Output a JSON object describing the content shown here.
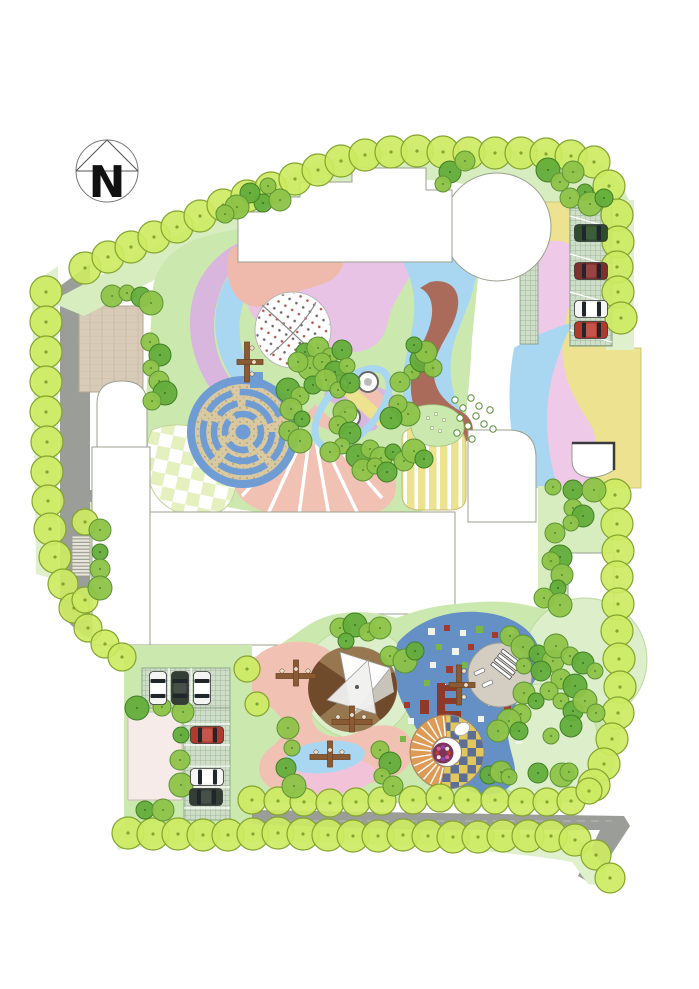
{
  "meta": {
    "width": 699,
    "height": 989,
    "plan_type": "landscape-site-plan"
  },
  "compass": {
    "label": "N"
  },
  "palette": {
    "bg": "#ffffff",
    "road": "#9b9d99",
    "paleStrip": "#dff0cd",
    "lawnBand": "#d7edc0",
    "lawn": "#cbe8ae",
    "paleCircle": "#ddeecb",
    "treePerimeterFill": "#cdea62",
    "treePerimeterEdge": "#84a430",
    "treeMedFill": "#8dc348",
    "treeMedEdge": "#5c9334",
    "treeDarkFill": "#63ad3b",
    "treeDarkEdge": "#417f24",
    "purpleBand": "#d9b6de",
    "blueLight": "#a9d7f1",
    "blueDeep": "#6490c6",
    "mazeBlue": "#6e9cd3",
    "mazeSand": "#d9c9a2",
    "salmon": "#efb9ab",
    "fanSalmon": "#f1c2b4",
    "purpleBig": "#e9c3e6",
    "rightPink": "#eec9e8",
    "yellow": "#ece28f",
    "brown": "#ab6b5a",
    "tanPlaza": "#d8cbb8",
    "gridBg": "#cedec8",
    "gridLine": "#93ab8d",
    "checkPale": "#e4f0bd",
    "checkYellow": "#e3c75a",
    "checkNavy": "#5d6e96",
    "amphOrange": "#de9b55",
    "plazaGray": "#d4cdc2",
    "sandRing": "#c7b193",
    "wedgeDark": "#6f4a2b",
    "wedgeMid": "#97774f",
    "wood": "#8a5a33",
    "woodDark": "#6e4526",
    "carWhite": "#f4f4f2",
    "carRed": "#b03a2e",
    "carDarkRed": "#7c3030",
    "carGreen": "#2f4c30",
    "carDark": "#343d36",
    "pixWhite": "#f2f2ee",
    "pixRed": "#a03c2e",
    "pixGreen": "#79b547",
    "pixYellow": "#e3cf58",
    "structRed": "#8e3a2a",
    "flowerBed": "#7c3558",
    "blobPink": "#f2c3d8",
    "pinkPlaza": "#f6ebe9",
    "buildingStroke": "#9aa08f"
  },
  "trees": {
    "perimeter": [
      [
        85,
        268
      ],
      [
        108,
        257
      ],
      [
        131,
        247
      ],
      [
        154,
        237
      ],
      [
        177,
        227
      ],
      [
        200,
        216
      ],
      [
        223,
        205
      ],
      [
        247,
        196
      ],
      [
        271,
        188
      ],
      [
        295,
        179
      ],
      [
        318,
        170
      ],
      [
        341,
        161
      ],
      [
        365,
        155
      ],
      [
        391,
        152
      ],
      [
        417,
        151
      ],
      [
        443,
        152
      ],
      [
        469,
        153
      ],
      [
        495,
        153
      ],
      [
        521,
        153
      ],
      [
        546,
        154
      ],
      [
        571,
        156
      ],
      [
        594,
        162
      ],
      [
        609,
        186
      ],
      [
        617,
        215
      ],
      [
        618,
        242
      ],
      [
        617,
        267
      ],
      [
        618,
        292
      ],
      [
        621,
        318
      ],
      [
        615,
        495
      ],
      [
        617,
        524
      ],
      [
        618,
        551
      ],
      [
        617,
        577
      ],
      [
        618,
        604
      ],
      [
        617,
        631
      ],
      [
        619,
        659
      ],
      [
        620,
        687
      ],
      [
        618,
        713
      ],
      [
        612,
        739
      ],
      [
        604,
        764
      ],
      [
        594,
        785
      ],
      [
        46,
        292
      ],
      [
        46,
        322
      ],
      [
        46,
        352
      ],
      [
        46,
        382
      ],
      [
        46,
        412
      ],
      [
        47,
        442
      ],
      [
        47,
        472
      ],
      [
        48,
        501
      ],
      [
        50,
        529
      ],
      [
        55,
        557
      ],
      [
        63,
        584,
        15
      ],
      [
        74,
        608,
        15
      ],
      [
        88,
        628,
        14
      ],
      [
        105,
        644,
        14
      ],
      [
        122,
        657,
        14
      ],
      [
        85,
        522,
        13
      ],
      [
        85,
        600,
        13
      ],
      [
        247,
        669,
        13
      ],
      [
        257,
        704,
        12
      ],
      [
        128,
        833
      ],
      [
        153,
        834
      ],
      [
        178,
        834
      ],
      [
        203,
        835
      ],
      [
        228,
        835
      ],
      [
        253,
        834
      ],
      [
        278,
        833
      ],
      [
        303,
        834
      ],
      [
        328,
        835
      ],
      [
        353,
        836
      ],
      [
        378,
        836
      ],
      [
        403,
        835
      ],
      [
        428,
        836
      ],
      [
        453,
        837
      ],
      [
        478,
        837
      ],
      [
        503,
        836
      ],
      [
        528,
        836
      ],
      [
        551,
        836
      ],
      [
        575,
        840
      ],
      [
        596,
        855,
        15
      ],
      [
        610,
        878,
        15
      ],
      [
        252,
        800,
        14
      ],
      [
        278,
        801,
        14
      ],
      [
        304,
        802,
        14
      ],
      [
        330,
        803,
        14
      ],
      [
        356,
        802,
        14
      ],
      [
        382,
        801,
        14
      ],
      [
        413,
        800,
        14
      ],
      [
        440,
        798,
        14
      ],
      [
        468,
        800,
        14
      ],
      [
        495,
        800,
        14
      ],
      [
        522,
        802,
        14
      ],
      [
        547,
        802,
        14
      ],
      [
        571,
        801,
        14
      ],
      [
        589,
        791,
        13
      ]
    ],
    "medium": [
      [
        263,
        203
      ],
      [
        280,
        200
      ],
      [
        268,
        186
      ],
      [
        250,
        193
      ],
      [
        237,
        207
      ],
      [
        225,
        214
      ],
      [
        450,
        172
      ],
      [
        443,
        184
      ],
      [
        465,
        161
      ],
      [
        548,
        170
      ],
      [
        560,
        182
      ],
      [
        573,
        172
      ],
      [
        585,
        192
      ],
      [
        570,
        198
      ],
      [
        590,
        204
      ],
      [
        604,
        198
      ],
      [
        112,
        296
      ],
      [
        127,
        293
      ],
      [
        141,
        297
      ],
      [
        151,
        303
      ],
      [
        150,
        342
      ],
      [
        160,
        355
      ],
      [
        151,
        368
      ],
      [
        159,
        381
      ],
      [
        165,
        393
      ],
      [
        152,
        401
      ],
      [
        100,
        530
      ],
      [
        100,
        552
      ],
      [
        100,
        569
      ],
      [
        100,
        588
      ],
      [
        305,
        352
      ],
      [
        318,
        348
      ],
      [
        330,
        356
      ],
      [
        342,
        350
      ],
      [
        310,
        368
      ],
      [
        322,
        362
      ],
      [
        335,
        372
      ],
      [
        347,
        366
      ],
      [
        298,
        362
      ],
      [
        288,
        390
      ],
      [
        300,
        396
      ],
      [
        291,
        409
      ],
      [
        302,
        419
      ],
      [
        289,
        431
      ],
      [
        300,
        441
      ],
      [
        313,
        385
      ],
      [
        326,
        380
      ],
      [
        338,
        390
      ],
      [
        350,
        383
      ],
      [
        345,
        412
      ],
      [
        338,
        425
      ],
      [
        350,
        433
      ],
      [
        342,
        446
      ],
      [
        330,
        452
      ],
      [
        358,
        456
      ],
      [
        370,
        449
      ],
      [
        381,
        458
      ],
      [
        393,
        452
      ],
      [
        404,
        461
      ],
      [
        414,
        451
      ],
      [
        424,
        459
      ],
      [
        363,
        470
      ],
      [
        375,
        466
      ],
      [
        387,
        472
      ],
      [
        408,
        414
      ],
      [
        398,
        404
      ],
      [
        391,
        418
      ],
      [
        412,
        372
      ],
      [
        400,
        382
      ],
      [
        422,
        360
      ],
      [
        433,
        368
      ],
      [
        426,
        352
      ],
      [
        414,
        345
      ],
      [
        510,
        636
      ],
      [
        523,
        647
      ],
      [
        538,
        654
      ],
      [
        553,
        661
      ],
      [
        524,
        666
      ],
      [
        541,
        671
      ],
      [
        556,
        646
      ],
      [
        570,
        656
      ],
      [
        583,
        663
      ],
      [
        595,
        671
      ],
      [
        561,
        679
      ],
      [
        575,
        686
      ],
      [
        549,
        691
      ],
      [
        524,
        693
      ],
      [
        536,
        701
      ],
      [
        521,
        714
      ],
      [
        509,
        721
      ],
      [
        519,
        731
      ],
      [
        498,
        731
      ],
      [
        561,
        701
      ],
      [
        573,
        711
      ],
      [
        585,
        701
      ],
      [
        596,
        713
      ],
      [
        571,
        726
      ],
      [
        551,
        736
      ],
      [
        340,
        628
      ],
      [
        355,
        625
      ],
      [
        368,
        632
      ],
      [
        380,
        628
      ],
      [
        346,
        641
      ],
      [
        390,
        656
      ],
      [
        405,
        661
      ],
      [
        415,
        651
      ],
      [
        288,
        728
      ],
      [
        292,
        748
      ],
      [
        286,
        768
      ],
      [
        294,
        786
      ],
      [
        380,
        750
      ],
      [
        390,
        763
      ],
      [
        382,
        776
      ],
      [
        393,
        786
      ],
      [
        137,
        708
      ],
      [
        162,
        707
      ],
      [
        183,
        712
      ],
      [
        181,
        735
      ],
      [
        180,
        760
      ],
      [
        181,
        785
      ],
      [
        145,
        810
      ],
      [
        163,
        810
      ],
      [
        553,
        487
      ],
      [
        573,
        490
      ],
      [
        594,
        490
      ],
      [
        573,
        508
      ],
      [
        583,
        516
      ],
      [
        571,
        523
      ],
      [
        555,
        533
      ],
      [
        560,
        557
      ],
      [
        551,
        561
      ],
      [
        562,
        575
      ],
      [
        558,
        588
      ],
      [
        544,
        598
      ],
      [
        560,
        605
      ],
      [
        489,
        775
      ],
      [
        501,
        772
      ],
      [
        509,
        777
      ],
      [
        538,
        773
      ],
      [
        562,
        775
      ],
      [
        569,
        772
      ]
    ],
    "bushes": [
      [
        455,
        400
      ],
      [
        463,
        408
      ],
      [
        471,
        398
      ],
      [
        479,
        406
      ],
      [
        460,
        418
      ],
      [
        468,
        426
      ],
      [
        476,
        416
      ],
      [
        484,
        424
      ],
      [
        490,
        410
      ],
      [
        493,
        429
      ],
      [
        457,
        433
      ],
      [
        472,
        439
      ]
    ],
    "flowers": [
      [
        428,
        418
      ],
      [
        436,
        414
      ],
      [
        444,
        420
      ],
      [
        432,
        428
      ],
      [
        440,
        431
      ]
    ]
  },
  "rings": [
    [
      338,
      385
    ],
    [
      368,
      382
    ],
    [
      350,
      417
    ]
  ],
  "pixels": [
    [
      428,
      628,
      7,
      "w"
    ],
    [
      444,
      625,
      6,
      "r"
    ],
    [
      460,
      630,
      6,
      "w"
    ],
    [
      476,
      626,
      7,
      "g"
    ],
    [
      492,
      632,
      6,
      "r"
    ],
    [
      508,
      628,
      6,
      "w"
    ],
    [
      436,
      644,
      6,
      "g"
    ],
    [
      452,
      648,
      7,
      "w"
    ],
    [
      468,
      644,
      6,
      "r"
    ],
    [
      484,
      650,
      6,
      "w"
    ],
    [
      500,
      646,
      7,
      "g"
    ],
    [
      516,
      650,
      6,
      "r"
    ],
    [
      430,
      662,
      6,
      "w"
    ],
    [
      446,
      666,
      7,
      "r"
    ],
    [
      462,
      662,
      6,
      "g"
    ],
    [
      478,
      668,
      6,
      "w"
    ],
    [
      494,
      664,
      7,
      "r"
    ],
    [
      510,
      670,
      6,
      "w"
    ],
    [
      424,
      680,
      6,
      "g"
    ],
    [
      440,
      684,
      6,
      "w"
    ],
    [
      480,
      682,
      7,
      "r"
    ],
    [
      496,
      686,
      6,
      "g"
    ],
    [
      512,
      682,
      6,
      "w"
    ],
    [
      488,
      700,
      6,
      "w"
    ],
    [
      504,
      704,
      7,
      "r"
    ],
    [
      520,
      700,
      6,
      "g"
    ],
    [
      478,
      716,
      6,
      "w"
    ],
    [
      494,
      720,
      6,
      "r"
    ],
    [
      510,
      716,
      7,
      "w"
    ],
    [
      404,
      702,
      6,
      "r"
    ],
    [
      408,
      718,
      6,
      "w"
    ],
    [
      400,
      736,
      6,
      "g"
    ],
    [
      412,
      752,
      7,
      "r"
    ],
    [
      424,
      744,
      6,
      "w"
    ],
    [
      500,
      734,
      6,
      "y"
    ],
    [
      516,
      738,
      6,
      "w"
    ]
  ],
  "cars": [
    {
      "x": 591,
      "y": 233,
      "rot": 0,
      "color": "carGreen"
    },
    {
      "x": 591,
      "y": 271,
      "rot": 0,
      "color": "carDarkRed"
    },
    {
      "x": 591,
      "y": 309,
      "rot": 0,
      "color": "carWhite"
    },
    {
      "x": 591,
      "y": 330,
      "rot": 0,
      "color": "carRed"
    },
    {
      "x": 158,
      "y": 688,
      "rot": 90,
      "color": "carWhite"
    },
    {
      "x": 180,
      "y": 688,
      "rot": 90,
      "color": "carDark"
    },
    {
      "x": 202,
      "y": 688,
      "rot": 90,
      "color": "carWhite"
    },
    {
      "x": 207,
      "y": 735,
      "rot": 0,
      "color": "carRed"
    },
    {
      "x": 207,
      "y": 777,
      "rot": 0,
      "color": "carWhite"
    },
    {
      "x": 206,
      "y": 797,
      "rot": 0,
      "color": "carDark"
    }
  ],
  "play_structures": [
    {
      "x": 247,
      "y": 362,
      "rot": 90
    },
    {
      "x": 296,
      "y": 676,
      "rot": 0
    },
    {
      "x": 352,
      "y": 722,
      "rot": 0
    },
    {
      "x": 330,
      "y": 757,
      "rot": 0
    },
    {
      "x": 459,
      "y": 685,
      "rot": 90
    }
  ],
  "amphitheater": {
    "cx": 447,
    "cy": 752,
    "r": 37,
    "innerR": 15,
    "lineStart": 104,
    "lineEnd": 264,
    "lineCount": 13
  },
  "flower_center": {
    "cx": 443,
    "cy": 753,
    "r": 10.5,
    "dotColors": [
      "#c0392b",
      "#d95fa0",
      "#8e44ad",
      "#e8e8e8"
    ]
  }
}
